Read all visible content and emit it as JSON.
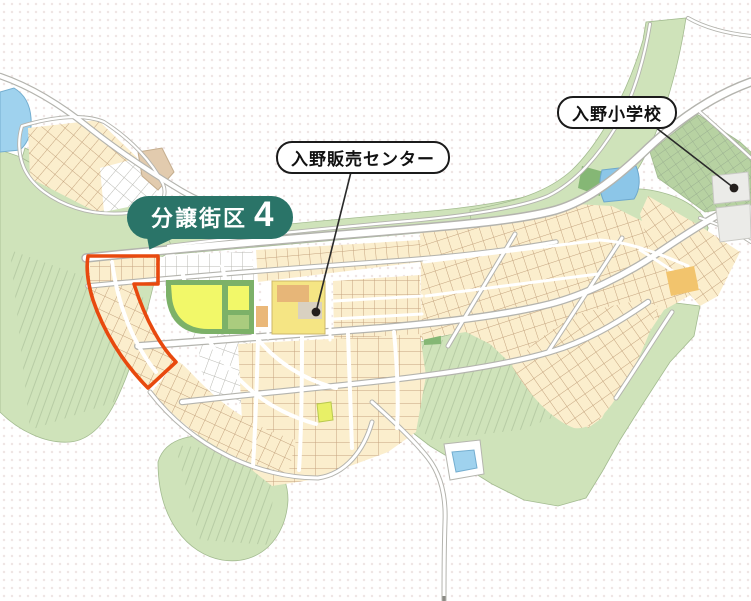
{
  "map": {
    "badge": {
      "label": "分譲街区",
      "number": "4"
    },
    "callouts": {
      "sales_center": {
        "label": "入野販売センター"
      },
      "school": {
        "label": "入野小学校"
      }
    },
    "colors": {
      "badge_bg": "#2a7468",
      "badge_text": "#ffffff",
      "highlight_outline": "#e8490e",
      "greenery": "#cfe3ba",
      "greenery_dark": "#85b775",
      "residential_lot": "#fbeecd",
      "lot_line": "#c4a37e",
      "unsold_lot": "#ffffff",
      "unsold_line": "#b9b9b3",
      "water": "#9fd2ee",
      "park_yellow": "#f2f869",
      "park_green": "#7cb168",
      "road_casing": "#b4b4ae",
      "sales_center_fill": "#f5e584",
      "school_fill": "#ebebe8",
      "background_dot": "#efe6e5",
      "leader_line": "#2a2a2a"
    }
  }
}
